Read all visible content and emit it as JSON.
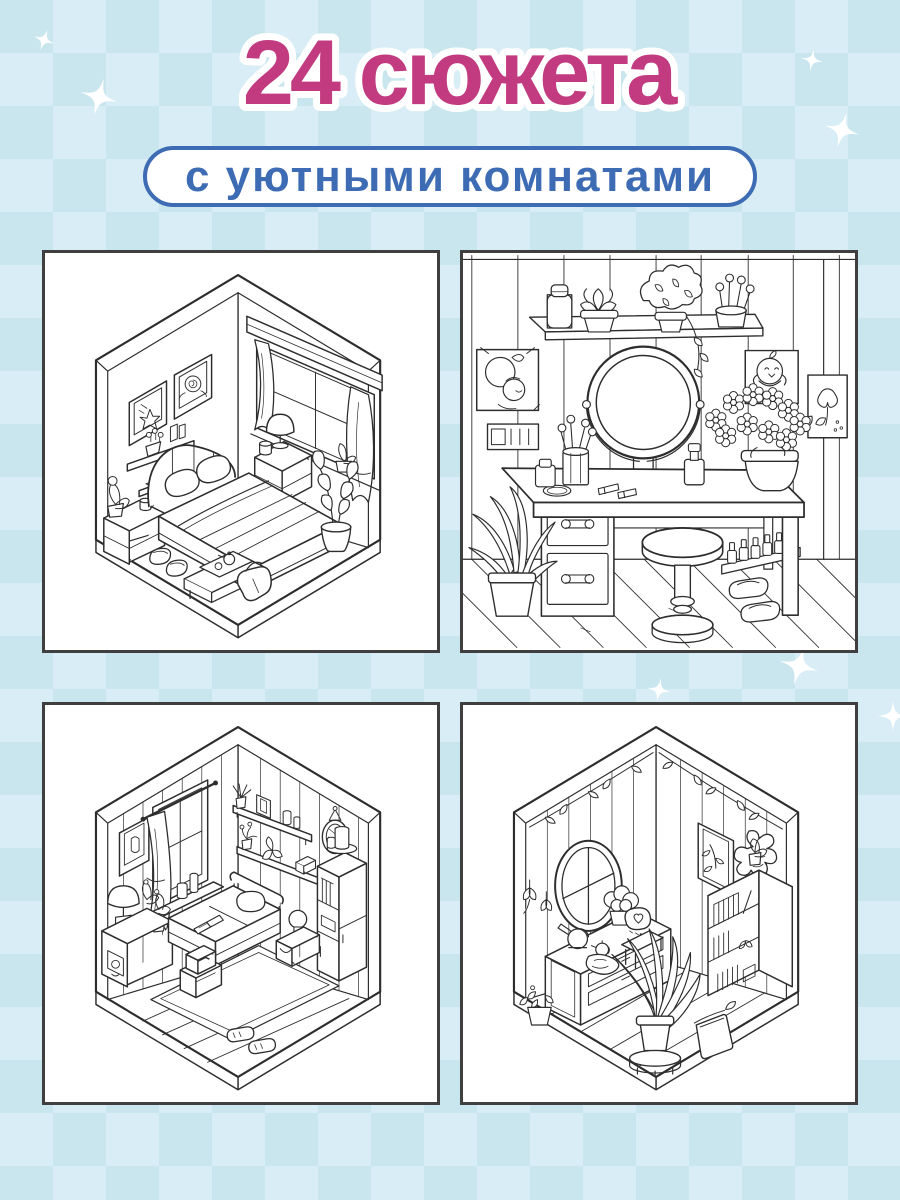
{
  "header": {
    "title": "24 сюжета",
    "subtitle": "с уютными комнатами"
  },
  "colors": {
    "background": "#cfe9f2",
    "checker_light": "#d8edf5",
    "checker_dark": "#c9e6ef",
    "title_pink": "#c23a7f",
    "title_outline": "#ffffff",
    "subtitle_blue": "#3d6cb4",
    "panel_background": "#ffffff",
    "panel_border": "#3f3f3f",
    "line_art": "#2d2d2d",
    "sparkle": "#ffffff"
  },
  "panels": [
    {
      "id": "panel-bedroom-isometric",
      "label": "isometric-bedroom-coloring-page"
    },
    {
      "id": "panel-vanity-table",
      "label": "vanity-table-with-round-mirror-coloring-page"
    },
    {
      "id": "panel-bedroom-shelves",
      "label": "isometric-bedroom-with-shelves-coloring-page"
    },
    {
      "id": "panel-plant-room",
      "label": "isometric-plant-room-coloring-page"
    }
  ],
  "decorations": {
    "sparkle_count": 7
  }
}
